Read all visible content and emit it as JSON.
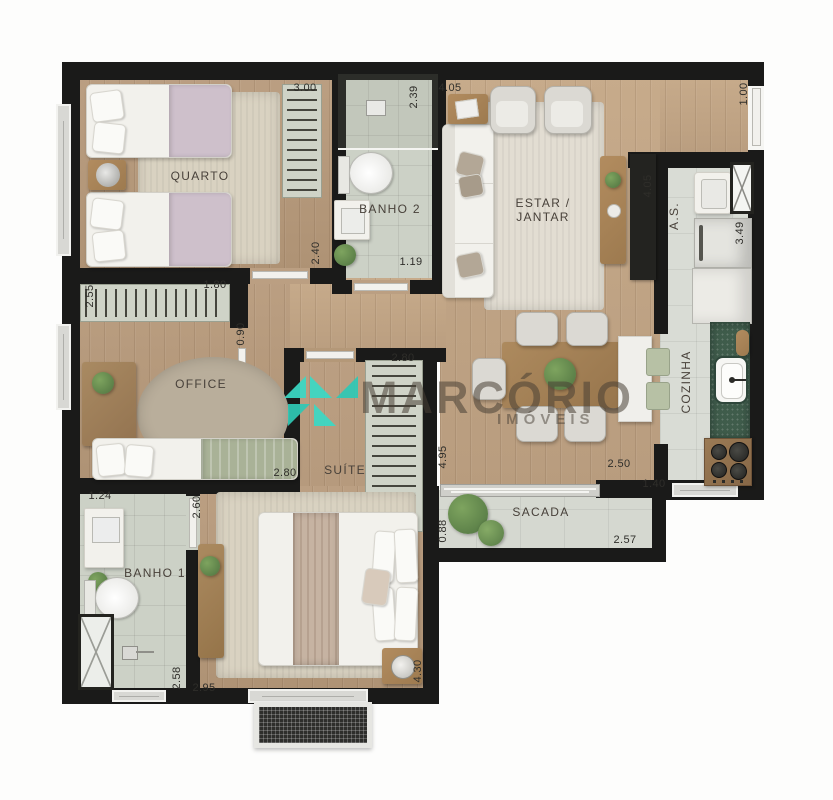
{
  "watermark": {
    "brand": "MARCÓRIO",
    "tagline": "IMÓVEIS",
    "logo_color": "#3BD9C5"
  },
  "rooms": [
    {
      "id": "quarto",
      "lines": [
        "QUARTO"
      ],
      "x": 200,
      "y": 176,
      "rot": 0
    },
    {
      "id": "banho2",
      "lines": [
        "BANHO 2"
      ],
      "x": 390,
      "y": 209,
      "rot": 0
    },
    {
      "id": "estar",
      "lines": [
        "ESTAR /",
        "JANTAR"
      ],
      "x": 543,
      "y": 210,
      "rot": 0
    },
    {
      "id": "as",
      "lines": [
        "A.S."
      ],
      "x": 674,
      "y": 216,
      "rot": -90
    },
    {
      "id": "cozinha",
      "lines": [
        "COZINHA"
      ],
      "x": 686,
      "y": 382,
      "rot": -90
    },
    {
      "id": "office",
      "lines": [
        "OFFICE"
      ],
      "x": 201,
      "y": 384,
      "rot": 0
    },
    {
      "id": "suite",
      "lines": [
        "SUÍTE"
      ],
      "x": 345,
      "y": 470,
      "rot": 0
    },
    {
      "id": "sacada",
      "lines": [
        "SACADA"
      ],
      "x": 541,
      "y": 512,
      "rot": 0
    },
    {
      "id": "banho1",
      "lines": [
        "BANHO 1"
      ],
      "x": 155,
      "y": 573,
      "rot": 0
    }
  ],
  "dimensions": [
    {
      "value": "3.00",
      "x": 305,
      "y": 88,
      "rot": 0
    },
    {
      "value": "2.39",
      "x": 414,
      "y": 97,
      "rot": -90
    },
    {
      "value": "4.05",
      "x": 450,
      "y": 88,
      "rot": 0
    },
    {
      "value": "1.00",
      "x": 744,
      "y": 94,
      "rot": -90
    },
    {
      "value": "4.05",
      "x": 648,
      "y": 186,
      "rot": -90
    },
    {
      "value": "3.49",
      "x": 740,
      "y": 233,
      "rot": -90
    },
    {
      "value": "2.40",
      "x": 316,
      "y": 253,
      "rot": -90
    },
    {
      "value": "1.19",
      "x": 411,
      "y": 262,
      "rot": 0
    },
    {
      "value": "2.55",
      "x": 90,
      "y": 296,
      "rot": -90
    },
    {
      "value": "1.80",
      "x": 215,
      "y": 285,
      "rot": 0
    },
    {
      "value": "0.90",
      "x": 241,
      "y": 334,
      "rot": -90
    },
    {
      "value": "2.80",
      "x": 403,
      "y": 358,
      "rot": 0
    },
    {
      "value": "2.80",
      "x": 285,
      "y": 473,
      "rot": 0
    },
    {
      "value": "4.95",
      "x": 443,
      "y": 457,
      "rot": -90
    },
    {
      "value": "2.50",
      "x": 619,
      "y": 464,
      "rot": 0
    },
    {
      "value": "1.40",
      "x": 654,
      "y": 484,
      "rot": 0
    },
    {
      "value": "0.88",
      "x": 443,
      "y": 531,
      "rot": -90
    },
    {
      "value": "2.57",
      "x": 625,
      "y": 540,
      "rot": 0
    },
    {
      "value": "1.24",
      "x": 100,
      "y": 496,
      "rot": 0
    },
    {
      "value": "2.60",
      "x": 197,
      "y": 507,
      "rot": -90
    },
    {
      "value": "2.58",
      "x": 177,
      "y": 678,
      "rot": -90
    },
    {
      "value": "2.95",
      "x": 204,
      "y": 688,
      "rot": 0
    },
    {
      "value": "4.30",
      "x": 418,
      "y": 671,
      "rot": -90
    }
  ]
}
